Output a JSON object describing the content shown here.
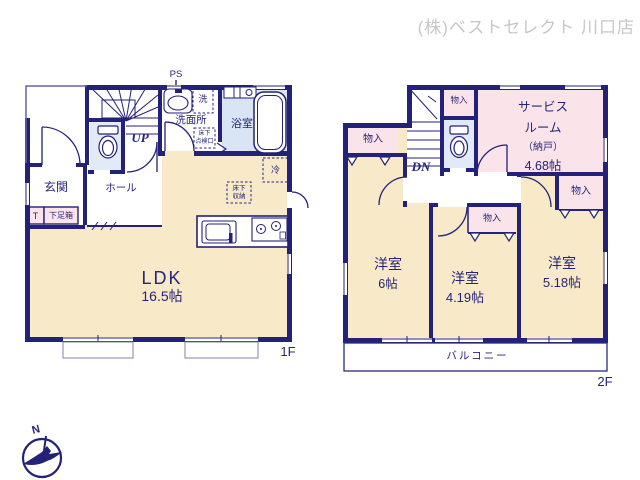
{
  "header": {
    "company_label": "(株)ベストセレクト 川口店"
  },
  "colors": {
    "wall_navy": "#232178",
    "text_navy": "#26257b",
    "room_cream": "#f8e9c9",
    "room_pink": "#fae3e9",
    "toilet_blue": "#e2eaf8",
    "bath_blue": "#d9e5f5",
    "watermark_gray": "#c7c7c9"
  },
  "floor1": {
    "label": "1F",
    "ldk": {
      "name": "LDK",
      "size": "16.5帖"
    },
    "genkan": "玄関",
    "hall": "ホール",
    "washroom": "洗面所",
    "bathroom": "浴室",
    "toilet_abbr": "T",
    "shoe_box": "下足箱",
    "stairs": "UP",
    "pipe_space": "PS",
    "laundry": "洗",
    "fridge": "冷",
    "underfloor_hatch": [
      "床下",
      "点検口"
    ],
    "underfloor_storage": [
      "床下",
      "収納"
    ]
  },
  "floor2": {
    "label": "2F",
    "service_room": {
      "name_line1": "サービス",
      "name_line2": "ルーム",
      "name_line3": "（納戸）",
      "size": "4.68帖"
    },
    "rooms": [
      {
        "name": "洋室",
        "size": "6帖"
      },
      {
        "name": "洋室",
        "size": "4.19帖"
      },
      {
        "name": "洋室",
        "size": "5.18帖"
      }
    ],
    "closet": "物入",
    "stairs": "DN",
    "balcony": "バルコニー"
  },
  "compass": {
    "north": "N"
  }
}
